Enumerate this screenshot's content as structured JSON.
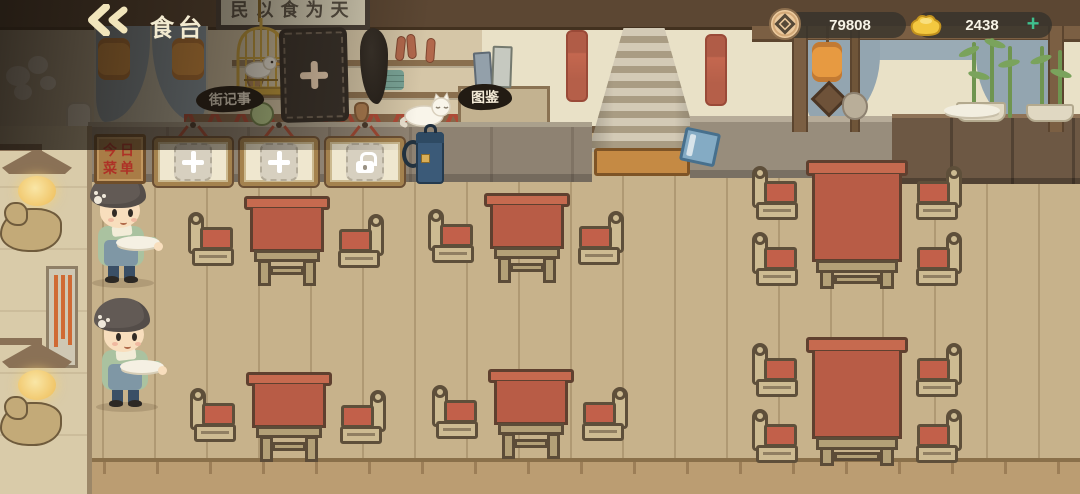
{
  "header": {
    "title": "食台"
  },
  "currency": {
    "coins_value": "79808",
    "ingots_value": "2438",
    "add_label": "+"
  },
  "wall": {
    "signboard_text": "民以食为天",
    "street_journal_label": "街记事",
    "catalog_label": "图鉴"
  },
  "menu": {
    "sign_line1": "今日",
    "sign_line2": "菜单",
    "slots": [
      {
        "type": "add"
      },
      {
        "type": "add"
      },
      {
        "type": "locked"
      }
    ]
  },
  "tables": [
    {
      "seats": 2,
      "x": 188,
      "y": 196
    },
    {
      "seats": 2,
      "x": 428,
      "y": 193
    },
    {
      "seats": 4,
      "x": 752,
      "y": 160
    },
    {
      "seats": 2,
      "x": 190,
      "y": 372
    },
    {
      "seats": 2,
      "x": 432,
      "y": 369
    },
    {
      "seats": 4,
      "x": 752,
      "y": 337
    }
  ],
  "servers": [
    {
      "x": 74,
      "y": 176
    },
    {
      "x": 78,
      "y": 300
    }
  ],
  "colors": {
    "table_red": "#b85c46",
    "gold": "#f3c840",
    "plus_green": "#3fc08e",
    "ink_label_bg": "#221b13"
  }
}
